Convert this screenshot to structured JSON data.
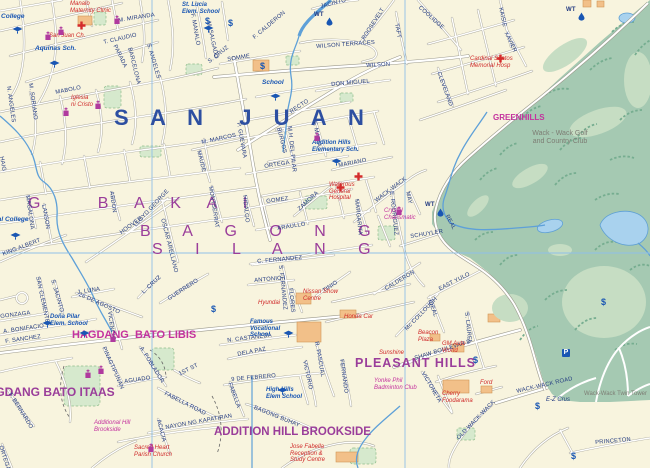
{
  "map": {
    "colors": {
      "base": "#f8f4de",
      "golf_green": "#a5c9b2",
      "fairway": "#c6ddc3",
      "park": "#d6e9cd",
      "water": "#a9d2ee",
      "stream": "#5ea0d8",
      "grid": "#8fc0e8",
      "road": "#ffffff",
      "casing": "#a8a699",
      "navy": "#223a80",
      "blue": "#2d4fa1",
      "purple": "#9a3d9a",
      "magenta": "#c4329e",
      "red": "#cf2a2a",
      "poiblue": "#1956b3",
      "gray": "#7d7d74",
      "building": "#f2c089"
    },
    "districts": [
      {
        "t": "S A N  J U A N",
        "x": 114,
        "y": 106,
        "c": "blue",
        "s": 22,
        "b": 1,
        "ls": 8
      },
      {
        "t": "G   B A K A I",
        "x": 28,
        "y": 196,
        "c": "purple",
        "s": 16,
        "ls": 11
      },
      {
        "t": "B A G O N G",
        "x": 140,
        "y": 224,
        "c": "purple",
        "s": 16,
        "ls": 14
      },
      {
        "t": "S I L A N G",
        "x": 152,
        "y": 242,
        "c": "purple",
        "s": 16,
        "ls": 14
      },
      {
        "t": "HAGDANG  BATO LIBIS",
        "x": 72,
        "y": 330,
        "c": "magenta",
        "s": 11,
        "b": 1
      },
      {
        "t": "HAGDANG BATO ITAAS",
        "x": -22,
        "y": 386,
        "c": "purple",
        "s": 12,
        "b": 1
      },
      {
        "t": "ADDITION HILL BROOKSIDE",
        "x": 214,
        "y": 426,
        "c": "purple",
        "s": 11.5,
        "b": 1
      },
      {
        "t": "PLEASANT HILLS",
        "x": 355,
        "y": 357,
        "c": "purple",
        "s": 12.5,
        "b": 1,
        "ls": 1
      },
      {
        "t": "GREENHILLS",
        "x": 493,
        "y": 114,
        "c": "magenta",
        "s": 8,
        "b": 1
      }
    ],
    "streets": [
      {
        "t": "M. MIRANDA",
        "x": 118,
        "y": 18,
        "r": -9
      },
      {
        "t": "T. CLAUDIO",
        "x": 103,
        "y": 40,
        "r": -13
      },
      {
        "t": "F. MANALO",
        "x": 195,
        "y": 13,
        "r": 80
      },
      {
        "t": "M. SALGADO",
        "x": 211,
        "y": 21,
        "r": 78
      },
      {
        "t": "S. CRUZ",
        "x": 207,
        "y": 60,
        "r": -38
      },
      {
        "t": "S. ANGELES",
        "x": 151,
        "y": 43,
        "r": 74
      },
      {
        "t": "BARCELONA",
        "x": 132,
        "y": 47,
        "r": 76
      },
      {
        "t": "PARADA",
        "x": 117,
        "y": 44,
        "r": 64
      },
      {
        "t": "F. CALDERON",
        "x": 252,
        "y": 36,
        "r": -40
      },
      {
        "t": "JACINTO",
        "x": 320,
        "y": 4,
        "r": -14
      },
      {
        "t": "SOMME",
        "x": 227,
        "y": 57,
        "r": -9
      },
      {
        "t": "MABOLO",
        "x": 55,
        "y": 90,
        "r": -11
      },
      {
        "t": "M. SORIANO",
        "x": 33,
        "y": 83,
        "r": 82
      },
      {
        "t": "N. ANGELES",
        "x": 11,
        "y": 86,
        "r": 82
      },
      {
        "t": "WILSON",
        "x": 366,
        "y": 63,
        "r": -3
      },
      {
        "t": "WILSON TERRACES",
        "x": 316,
        "y": 44,
        "r": -4
      },
      {
        "t": "DON MIGUEL",
        "x": 331,
        "y": 82,
        "r": -5
      },
      {
        "t": "RECTO",
        "x": 289,
        "y": 110,
        "r": -33
      },
      {
        "t": "ROOSEVELT",
        "x": 361,
        "y": 38,
        "r": -57
      },
      {
        "t": "TAFT",
        "x": 399,
        "y": 23,
        "r": 80
      },
      {
        "t": "COOLIDGE",
        "x": 421,
        "y": 5,
        "r": 42
      },
      {
        "t": "KAISIE",
        "x": 503,
        "y": 7,
        "r": 78
      },
      {
        "t": "XAVIER",
        "x": 508,
        "y": 31,
        "r": 64
      },
      {
        "t": "CLEVELAND",
        "x": 441,
        "y": 71,
        "r": 70
      },
      {
        "t": "HAIG",
        "x": 4,
        "y": 156,
        "r": 80
      },
      {
        "t": "M. MARCOS",
        "x": 201,
        "y": 140,
        "r": -12
      },
      {
        "t": "MAUDE",
        "x": 201,
        "y": 150,
        "r": 76
      },
      {
        "t": "P. GUEVARA",
        "x": 241,
        "y": 122,
        "r": 80
      },
      {
        "t": "ORTEGA",
        "x": 264,
        "y": 164,
        "r": -9
      },
      {
        "t": "GOMEZ",
        "x": 266,
        "y": 199,
        "r": -8
      },
      {
        "t": "MONTSERRAT",
        "x": 213,
        "y": 186,
        "r": 81
      },
      {
        "t": "HIDALGO",
        "x": 247,
        "y": 195,
        "r": 84
      },
      {
        "t": "ZAMORA",
        "x": 297,
        "y": 208,
        "r": -43
      },
      {
        "t": "BURGOS",
        "x": 281,
        "y": 127,
        "r": 76
      },
      {
        "t": "M.H. DEL PILAR",
        "x": 292,
        "y": 126,
        "r": 84
      },
      {
        "t": "F. MARIA",
        "x": 317,
        "y": 121,
        "r": 80
      },
      {
        "t": "MARIANO",
        "x": 338,
        "y": 163,
        "r": -11
      },
      {
        "t": "WACK-WACK",
        "x": 374,
        "y": 199,
        "r": -37
      },
      {
        "t": "MARGARITA",
        "x": 359,
        "y": 199,
        "r": 84
      },
      {
        "t": "E. RODRIGUEZ",
        "x": 394,
        "y": 191,
        "r": 84
      },
      {
        "t": "MAY",
        "x": 410,
        "y": 191,
        "r": 78
      },
      {
        "t": "SCHUYLER",
        "x": 410,
        "y": 234,
        "r": -9
      },
      {
        "t": "REAL",
        "x": 449,
        "y": 214,
        "r": 62
      },
      {
        "t": "ARAULLO",
        "x": 277,
        "y": 226,
        "r": -9
      },
      {
        "t": "HOOVER",
        "x": 119,
        "y": 231,
        "r": -36
      },
      {
        "t": "LLOYD GEORGE",
        "x": 133,
        "y": 224,
        "r": -47
      },
      {
        "t": "OSCAR ARELLANO",
        "x": 165,
        "y": 218,
        "r": 76
      },
      {
        "t": "ABDON",
        "x": 114,
        "y": 191,
        "r": 82
      },
      {
        "t": "MAGALONA",
        "x": 30,
        "y": 195,
        "r": 82
      },
      {
        "t": "LANSON",
        "x": 46,
        "y": 204,
        "r": 80
      },
      {
        "t": "KING ALBERT",
        "x": 2,
        "y": 252,
        "r": -21
      },
      {
        "t": "SAN CLEMENTE",
        "x": 40,
        "y": 276,
        "r": 78
      },
      {
        "t": "S. JACINTO",
        "x": 55,
        "y": 279,
        "r": 74
      },
      {
        "t": "J. LUNA",
        "x": 77,
        "y": 290,
        "r": -9
      },
      {
        "t": "26 DE AGOSTO",
        "x": 80,
        "y": 292,
        "r": 24
      },
      {
        "t": "VICENCIO",
        "x": 112,
        "y": 311,
        "r": 82
      },
      {
        "t": "L. CRUZ",
        "x": 141,
        "y": 291,
        "r": -43
      },
      {
        "t": "GUERRERO",
        "x": 167,
        "y": 297,
        "r": -33
      },
      {
        "t": "GONZAGA",
        "x": 0,
        "y": 314,
        "r": -7
      },
      {
        "t": "A. BONIFACIO",
        "x": 3,
        "y": 329,
        "r": -8
      },
      {
        "t": "F. SANCHEZ",
        "x": 5,
        "y": 339,
        "r": -8
      },
      {
        "t": "C. FERNANDEZ",
        "x": 257,
        "y": 259,
        "r": -5
      },
      {
        "t": "ANTONIO I",
        "x": 254,
        "y": 278,
        "r": -5
      },
      {
        "t": "S. FERNANDEZ",
        "x": 283,
        "y": 265,
        "r": 84
      },
      {
        "t": "FLORES",
        "x": 293,
        "y": 288,
        "r": 84
      },
      {
        "t": "TINIO",
        "x": 322,
        "y": 289,
        "r": -34
      },
      {
        "t": "CALDERON",
        "x": 384,
        "y": 287,
        "r": -31
      },
      {
        "t": "EAST YULO",
        "x": 438,
        "y": 287,
        "r": -27
      },
      {
        "t": "Mc COLLOUGH",
        "x": 404,
        "y": 328,
        "r": -46
      },
      {
        "t": "SHAW BOULEVAR D",
        "x": 414,
        "y": 356,
        "r": -17
      },
      {
        "t": "IDEAL",
        "x": 432,
        "y": 299,
        "r": 70
      },
      {
        "t": "S. LAUREL",
        "x": 469,
        "y": 312,
        "r": 84
      },
      {
        "t": "VICTONETA",
        "x": 425,
        "y": 371,
        "r": 60
      },
      {
        "t": "R. PASCUAL",
        "x": 319,
        "y": 341,
        "r": 80
      },
      {
        "t": "VICTORIO",
        "x": 307,
        "y": 360,
        "r": 78
      },
      {
        "t": "FERNANDO",
        "x": 344,
        "y": 359,
        "r": 82
      },
      {
        "t": "N. CASTANEDA",
        "x": 227,
        "y": 338,
        "r": -7
      },
      {
        "t": "DELA PAZ",
        "x": 237,
        "y": 352,
        "r": -11
      },
      {
        "t": "9 DE FEBRERO",
        "x": 231,
        "y": 377,
        "r": -5
      },
      {
        "t": "BAGONG BUHAY",
        "x": 255,
        "y": 405,
        "r": 22
      },
      {
        "t": "PINAGTIPUNAN",
        "x": 106,
        "y": 346,
        "r": 66
      },
      {
        "t": "A. POBLADOR",
        "x": 143,
        "y": 346,
        "r": 58
      },
      {
        "t": "1ST ST",
        "x": 178,
        "y": 372,
        "r": -27
      },
      {
        "t": "AGUADO",
        "x": 124,
        "y": 379,
        "r": -8
      },
      {
        "t": "FABELLA ROAD",
        "x": 166,
        "y": 391,
        "r": 27
      },
      {
        "t": "NAYON NG KAPATIRAN",
        "x": 165,
        "y": 425,
        "r": -10
      },
      {
        "t": "ACACIA",
        "x": 161,
        "y": 419,
        "r": 76
      },
      {
        "t": "FABELLA",
        "x": 232,
        "y": 382,
        "r": 70
      },
      {
        "t": "F. BERNARDO",
        "x": 12,
        "y": 392,
        "r": 58
      },
      {
        "t": "ORTEGA",
        "x": 3,
        "y": 445,
        "r": 72
      },
      {
        "t": "WACK-WACK ROAD",
        "x": 516,
        "y": 389,
        "r": -13
      },
      {
        "t": "OLD WACK-WACK",
        "x": 456,
        "y": 437,
        "r": -46
      },
      {
        "t": "PRINCETON",
        "x": 595,
        "y": 440,
        "r": -5
      },
      {
        "t": "WT",
        "x": 314,
        "y": 12,
        "s": 6,
        "b": 1
      },
      {
        "t": "WT",
        "x": 566,
        "y": 7,
        "s": 6,
        "b": 1
      },
      {
        "t": "WT",
        "x": 425,
        "y": 202,
        "s": 6,
        "b": 1
      }
    ],
    "places": [
      {
        "t": "Dominican College",
        "x": -34,
        "y": 13,
        "c": "poiblue",
        "i": 1,
        "b": 1,
        "s": 6.5
      },
      {
        "t": "Manalo\nMaternity Clinic",
        "x": 70,
        "y": 1,
        "c": "red",
        "i": 1,
        "s": 6
      },
      {
        "t": "San Juan Ch.",
        "x": 49,
        "y": 33,
        "c": "red",
        "i": 1,
        "s": 6
      },
      {
        "t": "Aquinas Sch.",
        "x": 35,
        "y": 45,
        "c": "poiblue",
        "i": 1,
        "b": 1,
        "s": 6.5
      },
      {
        "t": "St. Lucia\nElem. School",
        "x": 182,
        "y": 2,
        "c": "poiblue",
        "i": 1,
        "b": 1,
        "s": 6
      },
      {
        "t": "Iglesia\nni Cristo",
        "x": 71,
        "y": 95,
        "c": "red",
        "i": 1,
        "s": 6
      },
      {
        "t": "School",
        "x": 262,
        "y": 79,
        "c": "poiblue",
        "i": 1,
        "b": 1,
        "s": 6.5
      },
      {
        "t": "Cardinal Santos\nMemorial Hosp",
        "x": 470,
        "y": 56,
        "c": "red",
        "i": 1,
        "s": 6
      },
      {
        "t": "Rizal College",
        "x": -12,
        "y": 216,
        "c": "poiblue",
        "i": 1,
        "b": 1,
        "s": 6.5
      },
      {
        "t": "Doña Pilar\nElem. School",
        "x": 50,
        "y": 314,
        "c": "poiblue",
        "i": 1,
        "b": 1,
        "s": 6
      },
      {
        "t": "Addition Hills\nElementary Sch.",
        "x": 312,
        "y": 140,
        "c": "poiblue",
        "i": 1,
        "b": 1,
        "s": 6
      },
      {
        "t": "Waterous\nGeneral\nHospital",
        "x": 329,
        "y": 182,
        "c": "red",
        "i": 1,
        "s": 6
      },
      {
        "t": "Crystal\nCharismatic",
        "x": 384,
        "y": 208,
        "c": "magenta",
        "i": 1,
        "s": 6
      },
      {
        "t": "Famous\nVocational\nSchool",
        "x": 250,
        "y": 319,
        "c": "poiblue",
        "i": 1,
        "b": 1,
        "s": 6
      },
      {
        "t": "Nissan Show\nCentre",
        "x": 303,
        "y": 289,
        "c": "red",
        "i": 1,
        "s": 6
      },
      {
        "t": "Hyundai",
        "x": 258,
        "y": 300,
        "c": "red",
        "i": 1,
        "s": 6
      },
      {
        "t": "Honda Car",
        "x": 344,
        "y": 314,
        "c": "red",
        "i": 1,
        "s": 6
      },
      {
        "t": "High Hills\nElem School",
        "x": 266,
        "y": 387,
        "c": "poiblue",
        "i": 1,
        "b": 1,
        "s": 6
      },
      {
        "t": "Sunshine",
        "x": 379,
        "y": 350,
        "c": "red",
        "i": 1,
        "s": 6
      },
      {
        "t": "Beacon\nPlaza",
        "x": 418,
        "y": 330,
        "c": "red",
        "i": 1,
        "s": 6
      },
      {
        "t": "GM Auto\nWorld",
        "x": 442,
        "y": 341,
        "c": "red",
        "i": 1,
        "s": 6
      },
      {
        "t": "Cherry\nFoodarama",
        "x": 442,
        "y": 391,
        "c": "red",
        "i": 1,
        "s": 6
      },
      {
        "t": "Ford",
        "x": 480,
        "y": 380,
        "c": "red",
        "i": 1,
        "s": 6
      },
      {
        "t": "E-Z Crus",
        "x": 546,
        "y": 397,
        "c": "navy",
        "i": 1,
        "s": 6
      },
      {
        "t": "Yonke Phil\nBadminton Club",
        "x": 374,
        "y": 378,
        "c": "magenta",
        "i": 1,
        "s": 6
      },
      {
        "t": "Sacred Heart\nParish Church",
        "x": 134,
        "y": 445,
        "c": "red",
        "i": 1,
        "s": 6
      },
      {
        "t": "Jose Fabella\nReception &\nStudy Centre",
        "x": 290,
        "y": 444,
        "c": "red",
        "i": 1,
        "s": 6
      },
      {
        "t": "Additional Hill\nBrookside",
        "x": 94,
        "y": 420,
        "c": "magenta",
        "i": 1,
        "s": 6
      },
      {
        "t": "Wack - Wack Golf\nand Country Club",
        "x": 512,
        "y": 130,
        "c": "gray",
        "s": 7,
        "w": 96
      },
      {
        "t": "Wack-Wack Twin Tower",
        "x": 584,
        "y": 391,
        "c": "gray",
        "s": 6
      }
    ],
    "icons": [
      {
        "type": "church",
        "x": 44,
        "y": 28
      },
      {
        "type": "church",
        "x": 57,
        "y": 23
      },
      {
        "type": "church",
        "x": 113,
        "y": 12
      },
      {
        "type": "church",
        "x": 62,
        "y": 104
      },
      {
        "type": "church",
        "x": 94,
        "y": 97
      },
      {
        "type": "church",
        "x": 313,
        "y": 129
      },
      {
        "type": "church",
        "x": 395,
        "y": 203
      },
      {
        "type": "church",
        "x": 147,
        "y": 440
      },
      {
        "type": "church",
        "x": 84,
        "y": 366
      },
      {
        "type": "church",
        "x": 97,
        "y": 362
      },
      {
        "type": "church",
        "x": 109,
        "y": 330
      },
      {
        "type": "hospital-cross",
        "x": 77,
        "y": 17
      },
      {
        "type": "hospital-cross",
        "x": 496,
        "y": 50
      },
      {
        "type": "hospital-cross",
        "x": 336,
        "y": 179
      },
      {
        "type": "hospital-cross",
        "x": 354,
        "y": 168
      },
      {
        "type": "school",
        "x": 12,
        "y": 21
      },
      {
        "type": "school",
        "x": 49,
        "y": 55
      },
      {
        "type": "school",
        "x": 203,
        "y": 20
      },
      {
        "type": "school",
        "x": 270,
        "y": 88
      },
      {
        "type": "school",
        "x": 10,
        "y": 227
      },
      {
        "type": "school",
        "x": 42,
        "y": 315
      },
      {
        "type": "school",
        "x": 79,
        "y": 325
      },
      {
        "type": "school",
        "x": 283,
        "y": 325
      },
      {
        "type": "school",
        "x": 277,
        "y": 382
      },
      {
        "type": "school",
        "x": 331,
        "y": 153
      },
      {
        "type": "bank",
        "x": 205,
        "y": 11
      },
      {
        "type": "bank",
        "x": 228,
        "y": 13
      },
      {
        "type": "bank",
        "x": 260,
        "y": 56
      },
      {
        "type": "bank",
        "x": 211,
        "y": 299
      },
      {
        "type": "bank",
        "x": 601,
        "y": 292
      },
      {
        "type": "bank",
        "x": 473,
        "y": 350
      },
      {
        "type": "bank",
        "x": 535,
        "y": 396
      },
      {
        "type": "bank",
        "x": 571,
        "y": 446
      },
      {
        "type": "parking",
        "x": 562,
        "y": 349
      },
      {
        "type": "water-tank",
        "x": 326,
        "y": 13
      },
      {
        "type": "water-tank",
        "x": 578,
        "y": 8
      },
      {
        "type": "water-tank",
        "x": 437,
        "y": 204
      }
    ]
  }
}
